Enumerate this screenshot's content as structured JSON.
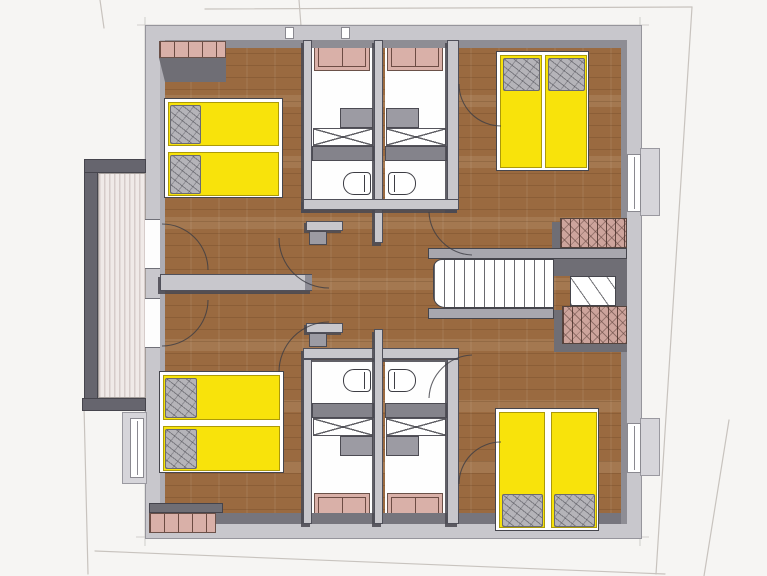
{
  "document": {
    "kind": "architectural-floor-plan",
    "style": "sketch 3d top-down (SketchUp-like)",
    "text_labels": []
  },
  "colors": {
    "background": "#f6f5f3",
    "floor_wood": "#9a6a40",
    "wall_light": "#c8c7cc",
    "wall_face": "#8e8d94",
    "wall_dark": "#6f6e75",
    "outline": "#3d3d44",
    "bed_yellow": "#f8e30b",
    "pillow_gray": "#b5b4b9",
    "cabinet_pink": "#d9b0a8",
    "cabinet_frame": "#6d4c44",
    "hatch_pink": "#cda49c",
    "balcony_light": "#f0eae8",
    "balcony_stripe": "#d6ccca",
    "railing_dark": "#66656e",
    "bath_white": "#fefefe",
    "counter_gray": "#9c9ba3",
    "partition_gray": "#84838b",
    "faint": "#c8c3be"
  },
  "rooms": [
    {
      "name": "bedroom-top-left",
      "furniture": [
        "double-bed (2 mattresses, yellow, pillows left)",
        "wardrobe (top wall)"
      ]
    },
    {
      "name": "bedroom-top-right",
      "furniture": [
        "double-bed (2 mattresses, yellow, pillows top)"
      ]
    },
    {
      "name": "bedroom-bottom-left",
      "furniture": [
        "double-bed (2 mattresses, yellow, pillows left)",
        "sideboard (bottom wall)"
      ]
    },
    {
      "name": "bedroom-bottom-right",
      "furniture": [
        "double-bed (2 mattresses, yellow, pillows bottom)"
      ]
    },
    {
      "name": "bathroom-top-left",
      "fixtures": [
        "cabinet",
        "washbasin-counter",
        "shower",
        "toilet"
      ]
    },
    {
      "name": "bathroom-top-right",
      "fixtures": [
        "cabinet",
        "washbasin-counter",
        "shower",
        "toilet"
      ]
    },
    {
      "name": "bathroom-bottom-left",
      "fixtures": [
        "toilet",
        "shower",
        "washbasin-counter",
        "cabinet"
      ]
    },
    {
      "name": "bathroom-bottom-right",
      "fixtures": [
        "toilet",
        "shower",
        "washbasin-counter",
        "cabinet"
      ]
    },
    {
      "name": "central-hall",
      "features": [
        "door swing arcs",
        "two balcony doors",
        "wall stubs"
      ]
    },
    {
      "name": "staircase",
      "features": [
        "straight flight",
        "winder turn",
        "hatched parapets top and bottom"
      ]
    },
    {
      "name": "balcony-left",
      "features": [
        "plank deck (vertical stripes)",
        "dark railing"
      ]
    }
  ]
}
